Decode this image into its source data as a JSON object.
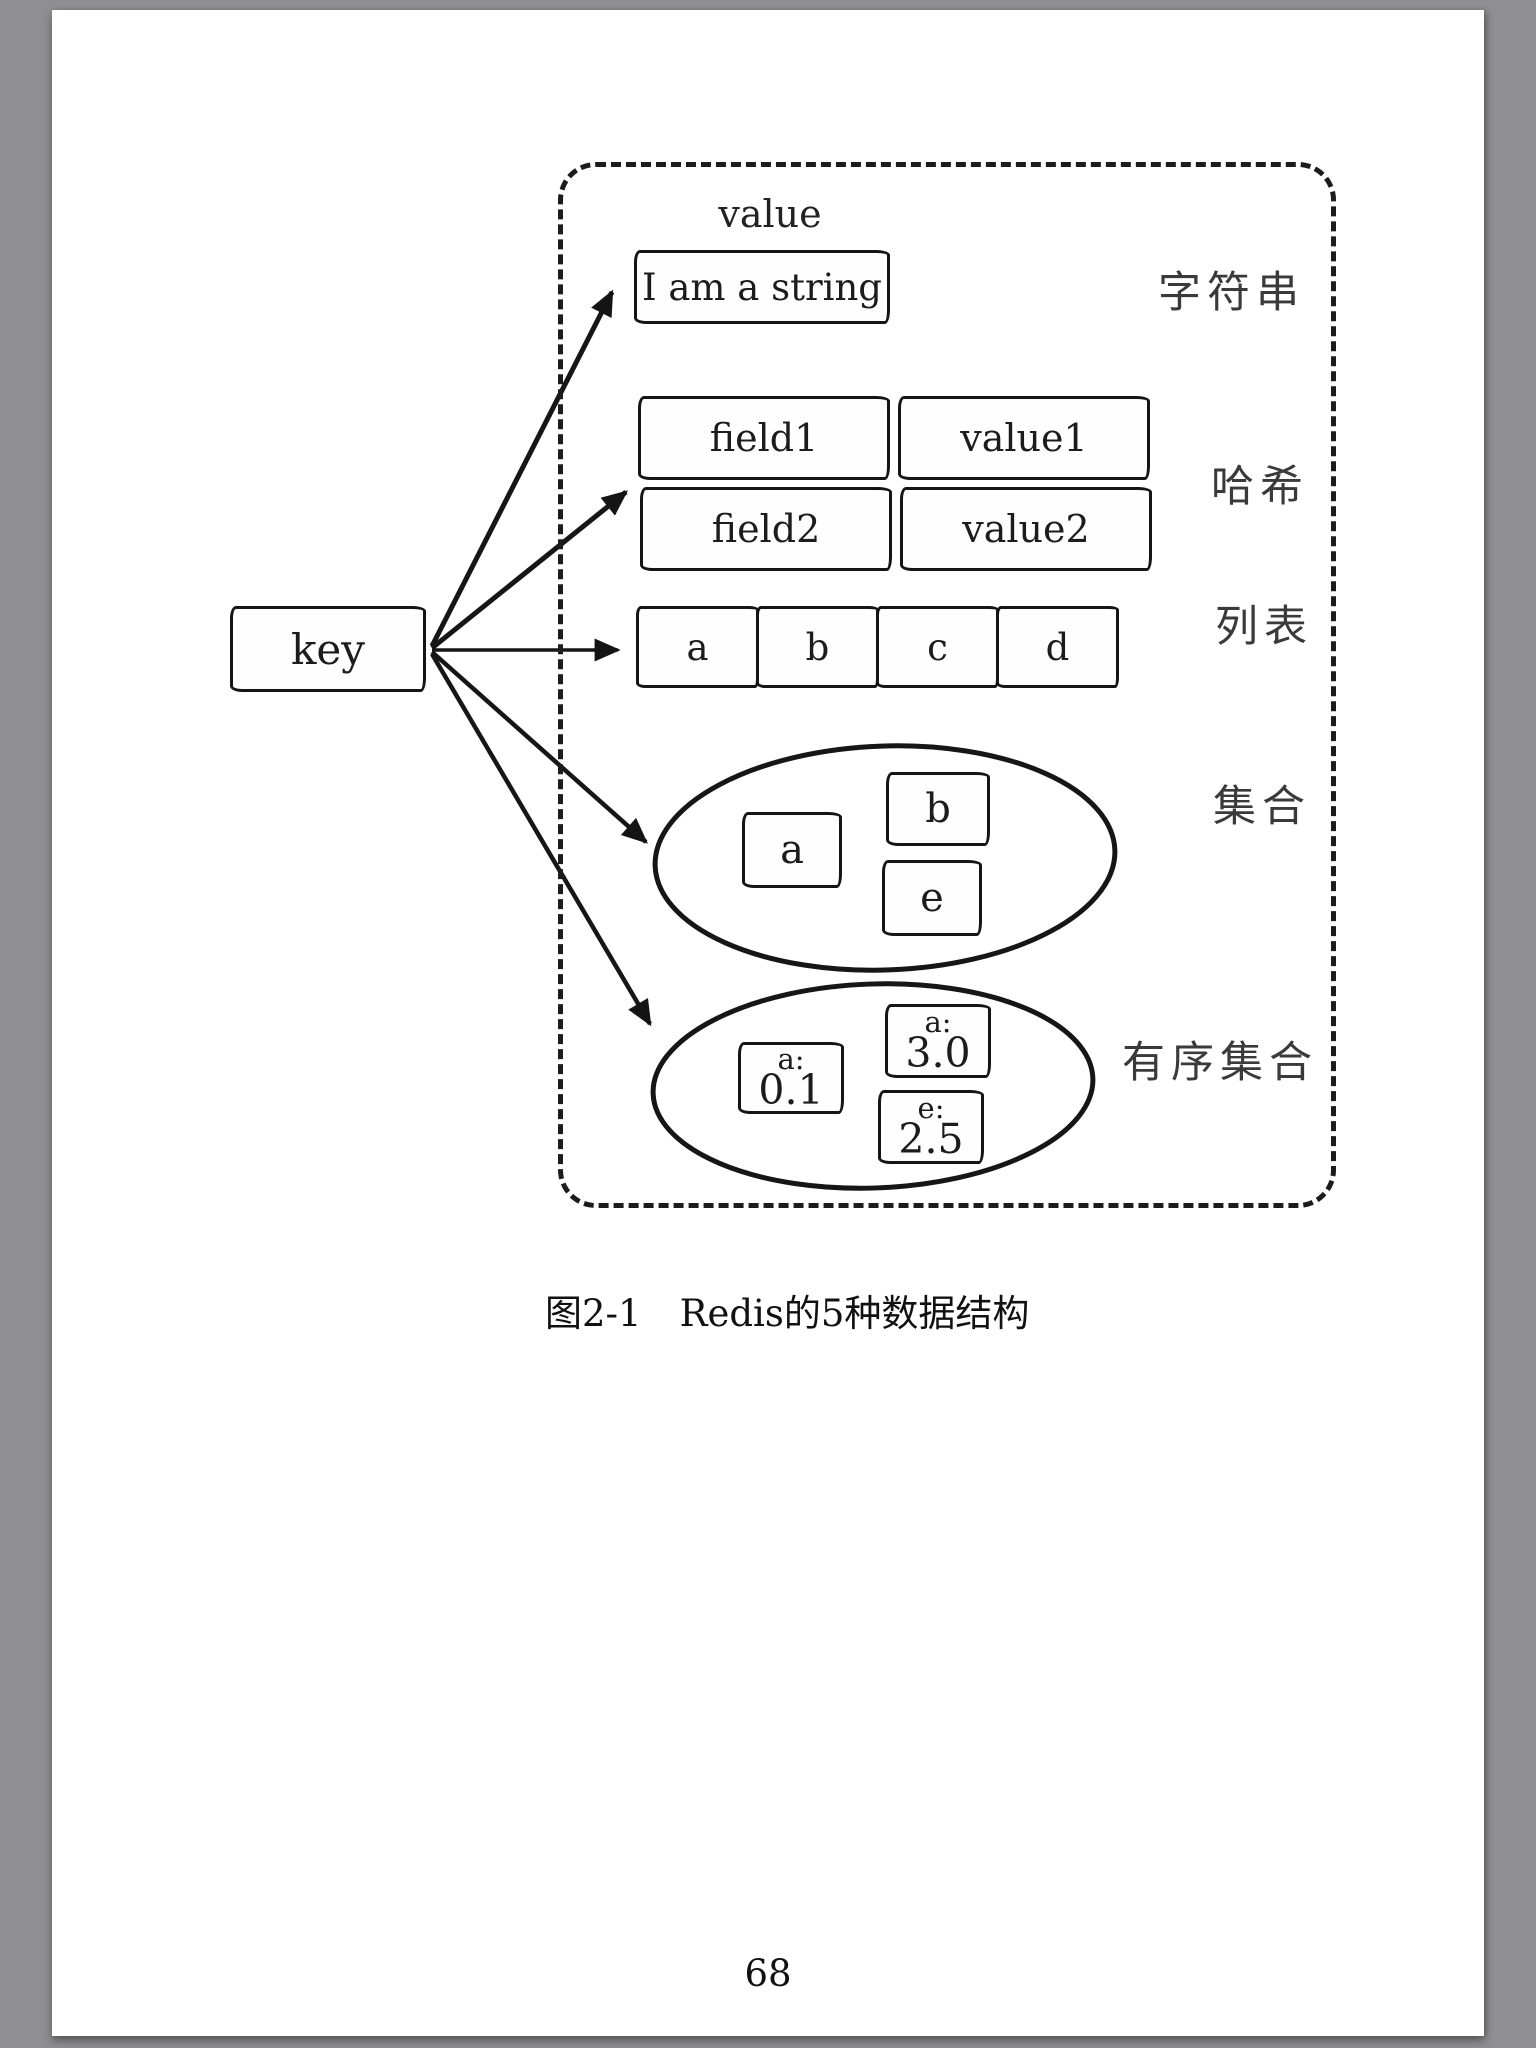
{
  "page": {
    "background_color": "#8e8e93",
    "paper_color": "#ffffff",
    "ink_color": "#1a1a1a",
    "caption_number": "图2-1",
    "caption_text": "Redis的5种数据结构",
    "page_number": "68"
  },
  "diagram": {
    "key_label": "key",
    "value_label": "value",
    "structures": [
      {
        "id": "string",
        "label": "字符串",
        "items": [
          "I am a string"
        ]
      },
      {
        "id": "hash",
        "label": "哈希",
        "rows": [
          [
            "field1",
            "value1"
          ],
          [
            "field2",
            "value2"
          ]
        ]
      },
      {
        "id": "list",
        "label": "列表",
        "items": [
          "a",
          "b",
          "c",
          "d"
        ]
      },
      {
        "id": "set",
        "label": "集合",
        "items": [
          "a",
          "b",
          "e"
        ]
      },
      {
        "id": "sorted-set",
        "label": "有序集合",
        "items": [
          {
            "member": "a:",
            "score": "0.1"
          },
          {
            "member": "a:",
            "score": "3.0"
          },
          {
            "member": "e:",
            "score": "2.5"
          }
        ]
      }
    ]
  }
}
